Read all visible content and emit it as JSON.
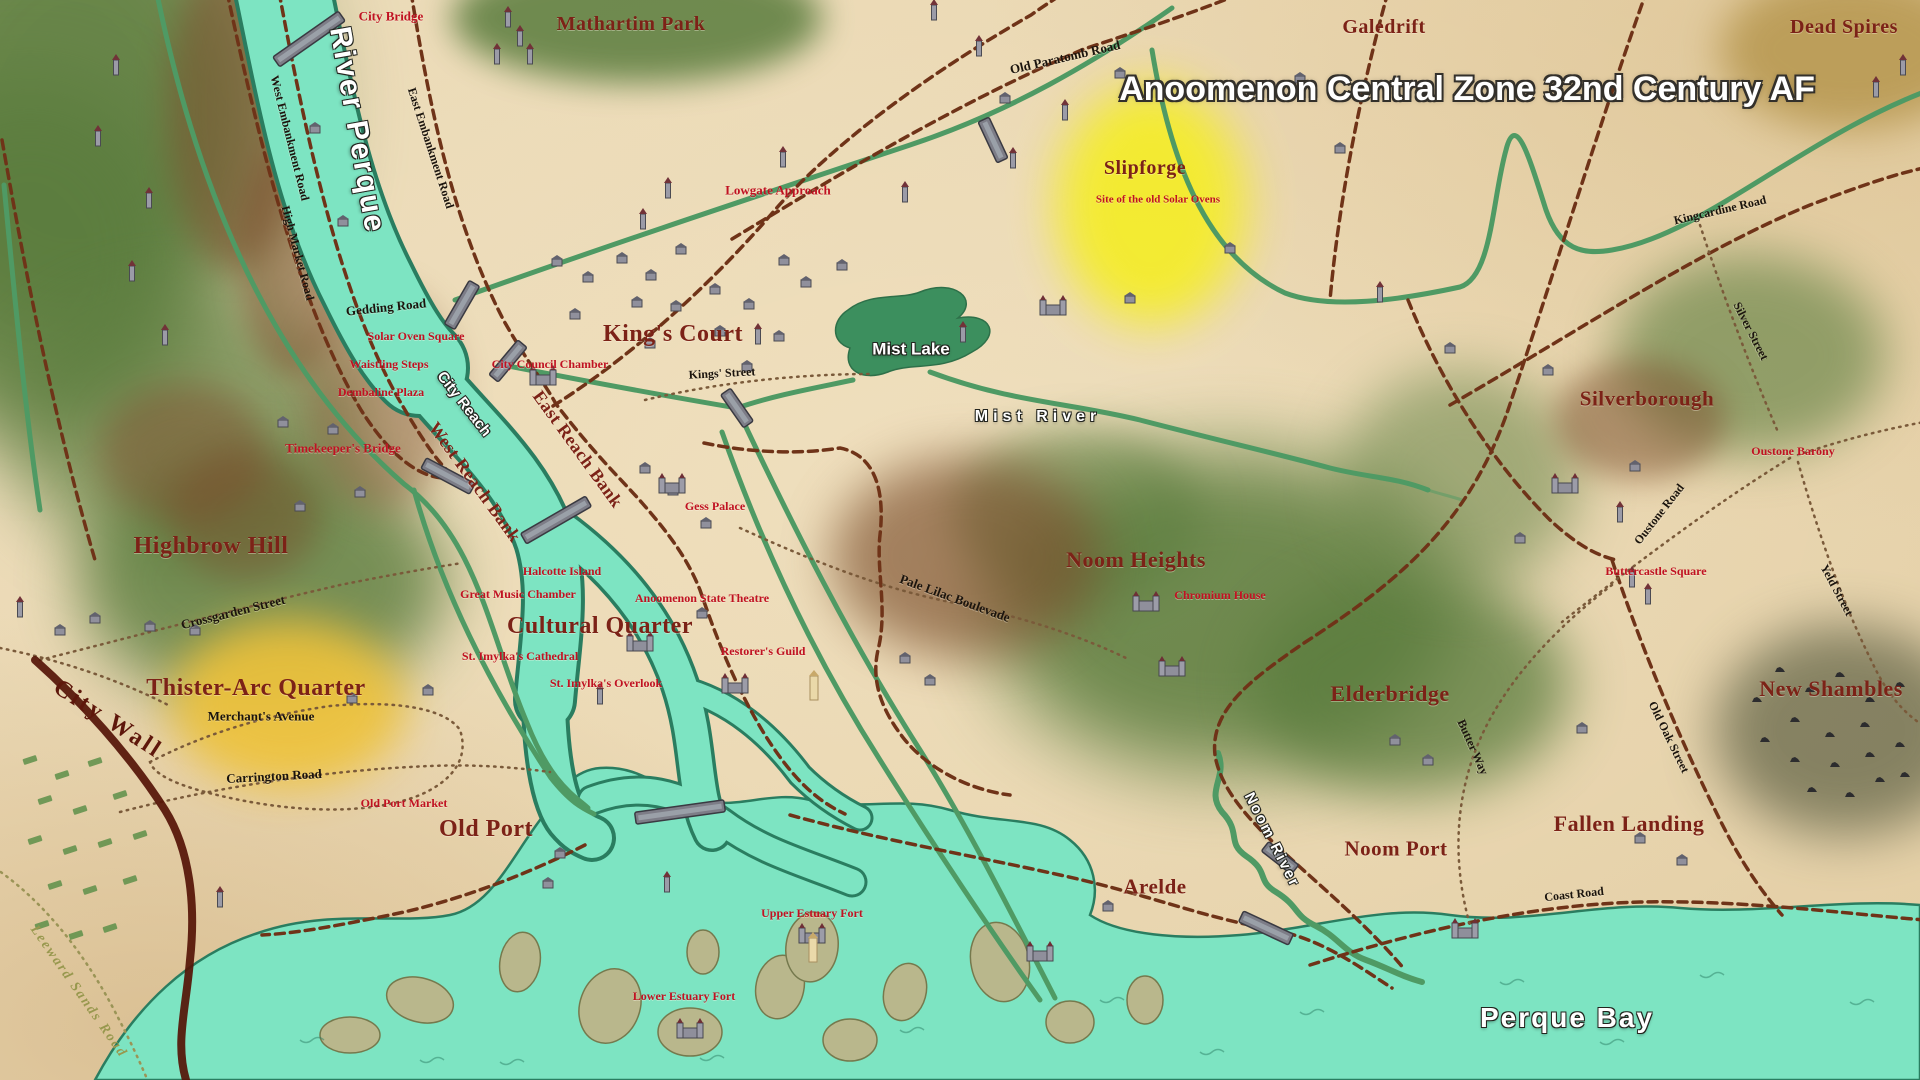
{
  "doc_title": "Anoomenon Central Zone 32nd Century AF",
  "palette": {
    "parchment": "#ead7b1",
    "water_teal": "#7de4c2",
    "water_edge": "#2a7d60",
    "lake_green": "#3c8f5e",
    "road_green": "#4f9a64",
    "road_dashed_brown": "#6f3318",
    "road_dotted": "#7a5a3a",
    "city_wall": "#551407",
    "district_text": "#7c2217",
    "poi_text": "#c01222",
    "road_text": "#1b140d",
    "water_text": "#ffffff",
    "f": "#5a7c3d",
    "h": "#7b4e2c",
    "y": "#f4ec2c",
    "o": "#eec23a",
    "s": "#6e6e50",
    "d": "#b6974f"
  },
  "labels": [
    {
      "id": "map-title",
      "t": "Anoomenon Central Zone 32nd Century AF",
      "x": 1467,
      "y": 89,
      "r": 0,
      "c": "title",
      "s": 34
    },
    {
      "id": "city-bridge",
      "t": "City Bridge",
      "x": 391,
      "y": 16,
      "r": 0,
      "c": "poi",
      "s": 13
    },
    {
      "id": "mathartim-park",
      "t": "Mathartim Park",
      "x": 631,
      "y": 24,
      "r": 0,
      "c": "district",
      "s": 20
    },
    {
      "id": "old-paratomb-road",
      "t": "Old Paratomb Road",
      "x": 1065,
      "y": 57,
      "r": -13,
      "c": "road",
      "s": 13
    },
    {
      "id": "galedrift",
      "t": "Galedrift",
      "x": 1384,
      "y": 27,
      "r": 0,
      "c": "district",
      "s": 20
    },
    {
      "id": "dead-spires",
      "t": "Dead Spires",
      "x": 1844,
      "y": 27,
      "r": 0,
      "c": "district",
      "s": 20
    },
    {
      "id": "river-perque",
      "t": "River Perque",
      "x": 357,
      "y": 130,
      "r": 80,
      "c": "waterlg",
      "s": 30
    },
    {
      "id": "west-embankment-road",
      "t": "West Embankment Road",
      "x": 290,
      "y": 138,
      "r": 76,
      "c": "road",
      "s": 12
    },
    {
      "id": "east-embankment-road",
      "t": "East Embankment Road",
      "x": 431,
      "y": 148,
      "r": 72,
      "c": "road",
      "s": 12
    },
    {
      "id": "high-market-road",
      "t": "High Market Road",
      "x": 298,
      "y": 253,
      "r": 75,
      "c": "road",
      "s": 12
    },
    {
      "id": "slipforge",
      "t": "Slipforge",
      "x": 1145,
      "y": 168,
      "r": 0,
      "c": "district",
      "s": 20
    },
    {
      "id": "solar-ovens-site",
      "t": "Site of the old Solar Ovens",
      "x": 1158,
      "y": 200,
      "r": 0,
      "c": "poi",
      "s": 11
    },
    {
      "id": "lowgate-approach",
      "t": "Lowgate Approach",
      "x": 778,
      "y": 190,
      "r": 0,
      "c": "poi",
      "s": 13
    },
    {
      "id": "kingcardine-road",
      "t": "Kingcardine Road",
      "x": 1720,
      "y": 210,
      "r": -13,
      "c": "road",
      "s": 12
    },
    {
      "id": "silver-street",
      "t": "Silver Street",
      "x": 1751,
      "y": 331,
      "r": 63,
      "c": "road",
      "s": 12
    },
    {
      "id": "gedding-road",
      "t": "Gedding Road",
      "x": 386,
      "y": 307,
      "r": -6,
      "c": "road",
      "s": 13
    },
    {
      "id": "solar-oven-square",
      "t": "Solar Oven Square",
      "x": 416,
      "y": 336,
      "r": 0,
      "c": "poi",
      "s": 12
    },
    {
      "id": "kings-court",
      "t": "King's Court",
      "x": 673,
      "y": 334,
      "r": 0,
      "c": "districtlg",
      "s": 24
    },
    {
      "id": "kings-street",
      "t": "Kings' Street",
      "x": 722,
      "y": 373,
      "r": -3,
      "c": "road",
      "s": 12
    },
    {
      "id": "waistling-steps",
      "t": "Waistling Steps",
      "x": 389,
      "y": 364,
      "r": 0,
      "c": "poi",
      "s": 12
    },
    {
      "id": "city-council-chamber",
      "t": "City Council Chamber",
      "x": 550,
      "y": 364,
      "r": 0,
      "c": "poi",
      "s": 12
    },
    {
      "id": "dembaline-plaza",
      "t": "Dembaline Plaza",
      "x": 381,
      "y": 392,
      "r": 0,
      "c": "poi",
      "s": 12
    },
    {
      "id": "mist-lake",
      "t": "Mist Lake",
      "x": 911,
      "y": 349,
      "r": 0,
      "c": "water",
      "s": 17
    },
    {
      "id": "mist-river",
      "t": "Mist River",
      "x": 1038,
      "y": 417,
      "r": 0,
      "c": "water",
      "s": 16,
      "ls": 5
    },
    {
      "id": "silverborough",
      "t": "Silverborough",
      "x": 1647,
      "y": 399,
      "r": 0,
      "c": "district",
      "s": 21
    },
    {
      "id": "city-reach",
      "t": "City Reach",
      "x": 464,
      "y": 404,
      "r": 52,
      "c": "water",
      "s": 15
    },
    {
      "id": "east-reach-bank",
      "t": "East Reach Bank",
      "x": 578,
      "y": 449,
      "r": 54,
      "c": "district",
      "s": 18
    },
    {
      "id": "west-reach-bank",
      "t": "West Reach Bank",
      "x": 475,
      "y": 482,
      "r": 54,
      "c": "district",
      "s": 18
    },
    {
      "id": "timekeepers-bridge",
      "t": "Timekeeper's Bridge",
      "x": 343,
      "y": 448,
      "r": 0,
      "c": "poi",
      "s": 13
    },
    {
      "id": "oustone-barony",
      "t": "Oustone Barony",
      "x": 1793,
      "y": 451,
      "r": 0,
      "c": "poi",
      "s": 12
    },
    {
      "id": "gess-palace",
      "t": "Gess Palace",
      "x": 715,
      "y": 506,
      "r": 0,
      "c": "poi",
      "s": 12
    },
    {
      "id": "oustone-road",
      "t": "Oustone Road",
      "x": 1659,
      "y": 514,
      "r": -52,
      "c": "road",
      "s": 12
    },
    {
      "id": "highbrow-hill",
      "t": "Highbrow Hill",
      "x": 211,
      "y": 546,
      "r": 0,
      "c": "districtlg",
      "s": 24
    },
    {
      "id": "noom-heights",
      "t": "Noom Heights",
      "x": 1136,
      "y": 560,
      "r": 0,
      "c": "districtlg",
      "s": 22
    },
    {
      "id": "halcotte-island",
      "t": "Halcotte Island",
      "x": 562,
      "y": 571,
      "r": 0,
      "c": "poi",
      "s": 12
    },
    {
      "id": "buttercastle-square",
      "t": "Buttercastle Square",
      "x": 1656,
      "y": 571,
      "r": 0,
      "c": "poi",
      "s": 12
    },
    {
      "id": "yeld-street",
      "t": "Yeld Street",
      "x": 1837,
      "y": 590,
      "r": 62,
      "c": "road",
      "s": 12
    },
    {
      "id": "chromium-house",
      "t": "Chromium House",
      "x": 1220,
      "y": 595,
      "r": 0,
      "c": "poi",
      "s": 12
    },
    {
      "id": "great-music-chamber",
      "t": "Great Music Chamber",
      "x": 518,
      "y": 594,
      "r": 0,
      "c": "poi",
      "s": 12
    },
    {
      "id": "anoomenon-state-theatre",
      "t": "Anoomenon State Theatre",
      "x": 702,
      "y": 598,
      "r": 0,
      "c": "poi",
      "s": 12
    },
    {
      "id": "pale-lilac-boulevade",
      "t": "Pale Lilac Boulevade",
      "x": 955,
      "y": 598,
      "r": 20,
      "c": "road",
      "s": 13
    },
    {
      "id": "cultural-quarter",
      "t": "Cultural Quarter",
      "x": 600,
      "y": 626,
      "r": 0,
      "c": "districtlg",
      "s": 24
    },
    {
      "id": "restorers-guild",
      "t": "Restorer's Guild",
      "x": 763,
      "y": 651,
      "r": 0,
      "c": "poi",
      "s": 12
    },
    {
      "id": "st-imylkas-cathedral",
      "t": "St. Imylka's Cathedral",
      "x": 520,
      "y": 656,
      "r": 0,
      "c": "poi",
      "s": 12
    },
    {
      "id": "crossgarden-street",
      "t": "Crossgarden Street",
      "x": 233,
      "y": 612,
      "r": -14,
      "c": "road",
      "s": 13
    },
    {
      "id": "st-imylkas-overlook",
      "t": "St. Imylka's Overlook",
      "x": 606,
      "y": 683,
      "r": 0,
      "c": "poi",
      "s": 12
    },
    {
      "id": "thister-arc-quarter",
      "t": "Thister-Arc Quarter",
      "x": 256,
      "y": 688,
      "r": 0,
      "c": "districtlg",
      "s": 24
    },
    {
      "id": "new-shambles",
      "t": "New Shambles",
      "x": 1831,
      "y": 689,
      "r": 0,
      "c": "districtlg",
      "s": 22
    },
    {
      "id": "elderbridge",
      "t": "Elderbridge",
      "x": 1390,
      "y": 694,
      "r": 0,
      "c": "districtlg",
      "s": 22
    },
    {
      "id": "merchants-avenue",
      "t": "Merchant's Avenue",
      "x": 261,
      "y": 716,
      "r": 0,
      "c": "road",
      "s": 13
    },
    {
      "id": "city-wall",
      "t": "City Wall",
      "x": 108,
      "y": 719,
      "r": 33,
      "c": "wall",
      "s": 24
    },
    {
      "id": "butter-way",
      "t": "Butter Way",
      "x": 1473,
      "y": 747,
      "r": 66,
      "c": "road",
      "s": 12
    },
    {
      "id": "old-oak-street",
      "t": "Old Oak Street",
      "x": 1669,
      "y": 737,
      "r": 64,
      "c": "road",
      "s": 12
    },
    {
      "id": "carrington-road",
      "t": "Carrington Road",
      "x": 274,
      "y": 776,
      "r": -3,
      "c": "road",
      "s": 13
    },
    {
      "id": "old-port-market",
      "t": "Old Port Market",
      "x": 404,
      "y": 803,
      "r": 0,
      "c": "poi",
      "s": 12
    },
    {
      "id": "old-port",
      "t": "Old Port",
      "x": 486,
      "y": 829,
      "r": 0,
      "c": "districtlg",
      "s": 24
    },
    {
      "id": "fallen-landing",
      "t": "Fallen Landing",
      "x": 1629,
      "y": 824,
      "r": 0,
      "c": "districtlg",
      "s": 22
    },
    {
      "id": "noom-port",
      "t": "Noom Port",
      "x": 1396,
      "y": 849,
      "r": 0,
      "c": "districtlg",
      "s": 21
    },
    {
      "id": "noom-river",
      "t": "Noom River",
      "x": 1272,
      "y": 840,
      "r": 63,
      "c": "water",
      "s": 15,
      "ls": 2
    },
    {
      "id": "arelde",
      "t": "Arelde",
      "x": 1155,
      "y": 887,
      "r": 0,
      "c": "districtlg",
      "s": 21
    },
    {
      "id": "coast-road",
      "t": "Coast Road",
      "x": 1574,
      "y": 894,
      "r": -6,
      "c": "road",
      "s": 12
    },
    {
      "id": "upper-estuary-fort",
      "t": "Upper Estuary Fort",
      "x": 812,
      "y": 913,
      "r": 0,
      "c": "poi",
      "s": 12
    },
    {
      "id": "leeward-sands-road",
      "t": "Leeward Sands Road",
      "x": 78,
      "y": 992,
      "r": 55,
      "c": "olive",
      "s": 14
    },
    {
      "id": "lower-estuary-fort",
      "t": "Lower Estuary Fort",
      "x": 684,
      "y": 996,
      "r": 0,
      "c": "poi",
      "s": 12
    },
    {
      "id": "perque-bay",
      "t": "Perque Bay",
      "x": 1567,
      "y": 1018,
      "r": 0,
      "c": "waterlg",
      "s": 28
    }
  ],
  "decor": {
    "terrain": [
      [
        74,
        110,
        440,
        510,
        "f",
        0.9
      ],
      [
        30,
        257,
        320,
        360,
        "f",
        0.8
      ],
      [
        184,
        428,
        360,
        270,
        "f",
        0.65
      ],
      [
        263,
        581,
        370,
        250,
        "f",
        0.8
      ],
      [
        637,
        18,
        370,
        130,
        "f",
        0.85
      ],
      [
        1225,
        612,
        470,
        320,
        "f",
        0.85
      ],
      [
        1410,
        685,
        320,
        220,
        "f",
        0.75
      ],
      [
        1078,
        514,
        250,
        170,
        "f",
        0.55
      ],
      [
        1750,
        355,
        270,
        200,
        "f",
        0.6
      ],
      [
        1460,
        480,
        240,
        220,
        "f",
        0.5
      ],
      [
        233,
        110,
        130,
        320,
        "h",
        0.55
      ],
      [
        294,
        257,
        110,
        240,
        "h",
        0.5
      ],
      [
        184,
        453,
        170,
        140,
        "h",
        0.5
      ],
      [
        245,
        515,
        150,
        130,
        "h",
        0.45
      ],
      [
        967,
        557,
        270,
        200,
        "h",
        0.65
      ],
      [
        1640,
        420,
        170,
        120,
        "h",
        0.5
      ],
      [
        380,
        400,
        150,
        220,
        "h",
        0.45
      ],
      [
        1151,
        205,
        190,
        240,
        "y",
        0.95
      ],
      [
        288,
        704,
        235,
        170,
        "o",
        0.9
      ],
      [
        1845,
        730,
        260,
        210,
        "s",
        0.8
      ],
      [
        1850,
        50,
        260,
        160,
        "d",
        0.85
      ]
    ],
    "buildings": [
      [
        557,
        263
      ],
      [
        588,
        279
      ],
      [
        622,
        260
      ],
      [
        651,
        277
      ],
      [
        681,
        251
      ],
      [
        637,
        304
      ],
      [
        676,
        308
      ],
      [
        715,
        291
      ],
      [
        749,
        306
      ],
      [
        784,
        262
      ],
      [
        806,
        284
      ],
      [
        842,
        267
      ],
      [
        720,
        333
      ],
      [
        779,
        338
      ],
      [
        575,
        316
      ],
      [
        747,
        368
      ],
      [
        650,
        345
      ],
      [
        343,
        223
      ],
      [
        315,
        130
      ],
      [
        673,
        492
      ],
      [
        706,
        525
      ],
      [
        645,
        470
      ],
      [
        702,
        615
      ],
      [
        905,
        660
      ],
      [
        930,
        682
      ],
      [
        560,
        855
      ],
      [
        548,
        885
      ],
      [
        1548,
        372
      ],
      [
        1635,
        468
      ],
      [
        1520,
        540
      ],
      [
        1450,
        350
      ],
      [
        1230,
        250
      ],
      [
        1130,
        300
      ],
      [
        1395,
        742
      ],
      [
        1428,
        762
      ],
      [
        1582,
        730
      ],
      [
        1640,
        840
      ],
      [
        1682,
        862
      ],
      [
        1108,
        908
      ],
      [
        352,
        700
      ],
      [
        428,
        692
      ],
      [
        1300,
        80
      ],
      [
        1340,
        150
      ],
      [
        283,
        424
      ],
      [
        333,
        431
      ],
      [
        360,
        494
      ],
      [
        300,
        508
      ],
      [
        150,
        628
      ],
      [
        195,
        632
      ],
      [
        60,
        632
      ],
      [
        95,
        620
      ],
      [
        1005,
        100
      ],
      [
        1120,
        75
      ]
    ],
    "towers": [
      [
        643,
        227
      ],
      [
        668,
        196
      ],
      [
        758,
        342
      ],
      [
        783,
        165
      ],
      [
        1013,
        166
      ],
      [
        1065,
        118
      ],
      [
        963,
        340
      ],
      [
        905,
        200
      ],
      [
        508,
        25
      ],
      [
        520,
        44
      ],
      [
        497,
        62
      ],
      [
        530,
        62
      ],
      [
        116,
        73
      ],
      [
        98,
        144
      ],
      [
        149,
        206
      ],
      [
        132,
        279
      ],
      [
        165,
        343
      ],
      [
        20,
        615
      ],
      [
        220,
        905
      ],
      [
        1876,
        95
      ],
      [
        1903,
        73
      ],
      [
        600,
        702
      ],
      [
        667,
        890
      ],
      [
        934,
        18
      ],
      [
        979,
        54
      ],
      [
        1620,
        520
      ],
      [
        1632,
        585
      ],
      [
        1648,
        602
      ],
      [
        1380,
        300
      ]
    ],
    "castles": [
      [
        672,
        490
      ],
      [
        1053,
        312
      ],
      [
        640,
        648
      ],
      [
        735,
        690
      ],
      [
        812,
        940
      ],
      [
        690,
        1035
      ],
      [
        1040,
        958
      ],
      [
        1465,
        935
      ],
      [
        1146,
        608
      ],
      [
        1172,
        673
      ],
      [
        1565,
        490
      ],
      [
        543,
        382
      ]
    ],
    "marks": [
      [
        1780,
        670
      ],
      [
        1810,
        690
      ],
      [
        1840,
        675
      ],
      [
        1870,
        700
      ],
      [
        1900,
        685
      ],
      [
        1795,
        720
      ],
      [
        1830,
        735
      ],
      [
        1865,
        725
      ],
      [
        1795,
        760
      ],
      [
        1835,
        765
      ],
      [
        1870,
        755
      ],
      [
        1900,
        745
      ],
      [
        1812,
        790
      ],
      [
        1850,
        795
      ],
      [
        1880,
        780
      ],
      [
        1905,
        775
      ],
      [
        1765,
        740
      ],
      [
        1757,
        700
      ]
    ],
    "fields": [
      [
        30,
        760
      ],
      [
        62,
        775
      ],
      [
        95,
        762
      ],
      [
        45,
        800
      ],
      [
        80,
        810
      ],
      [
        120,
        795
      ],
      [
        35,
        840
      ],
      [
        70,
        850
      ],
      [
        105,
        843
      ],
      [
        140,
        835
      ],
      [
        55,
        885
      ],
      [
        90,
        890
      ],
      [
        130,
        880
      ],
      [
        42,
        925
      ],
      [
        76,
        935
      ],
      [
        110,
        928
      ]
    ],
    "lighttowers": [
      [
        814,
        698
      ],
      [
        813,
        960
      ]
    ],
    "bridges": [
      [
        309,
        39,
        -35,
        80
      ],
      [
        508,
        361,
        -50,
        45
      ],
      [
        462,
        305,
        -60,
        50
      ],
      [
        448,
        476,
        28,
        55
      ],
      [
        556,
        520,
        -30,
        75
      ],
      [
        680,
        812,
        -8,
        90
      ],
      [
        1266,
        928,
        25,
        55
      ],
      [
        1280,
        858,
        38,
        38
      ],
      [
        737,
        408,
        55,
        40
      ],
      [
        993,
        140,
        65,
        45
      ]
    ],
    "waves": [
      [
        300,
        1040
      ],
      [
        500,
        1062
      ],
      [
        700,
        1058
      ],
      [
        900,
        1030
      ],
      [
        1100,
        1000
      ],
      [
        1300,
        1012
      ],
      [
        1500,
        982
      ],
      [
        1700,
        975
      ],
      [
        1850,
        1002
      ],
      [
        1200,
        1052
      ],
      [
        1600,
        1042
      ],
      [
        420,
        1060
      ]
    ]
  }
}
